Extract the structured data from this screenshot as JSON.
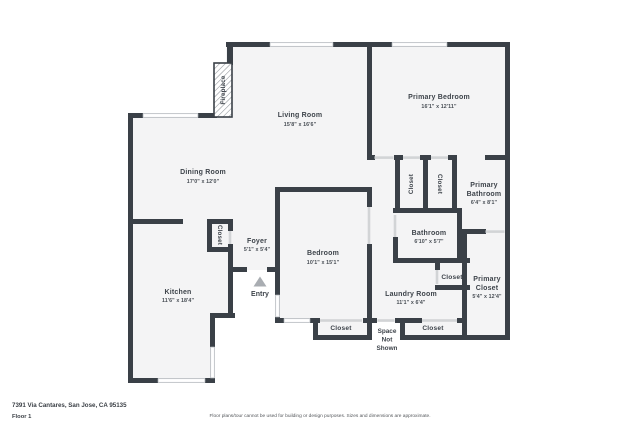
{
  "plan": {
    "rooms": {
      "living_room": {
        "name": "Living Room",
        "dims": "15'8\" x 16'6\""
      },
      "primary_bedroom": {
        "name": "Primary Bedroom",
        "dims": "16'1\" x 12'11\""
      },
      "dining_room": {
        "name": "Dining Room",
        "dims": "17'0\" x 12'0\""
      },
      "kitchen": {
        "name": "Kitchen",
        "dims": "11'6\" x 18'4\""
      },
      "foyer": {
        "name": "Foyer",
        "dims": "5'1\" x 5'4\""
      },
      "bedroom": {
        "name": "Bedroom",
        "dims": "10'1\" x 15'1\""
      },
      "bathroom": {
        "name": "Bathroom",
        "dims": "6'10\" x 5'7\""
      },
      "primary_bathroom": {
        "line1": "Primary",
        "line2": "Bathroom",
        "dims": "6'4\" x 8'1\""
      },
      "primary_closet": {
        "line1": "Primary",
        "line2": "Closet",
        "dims": "5'4\" x 12'4\""
      },
      "laundry_room": {
        "name": "Laundry Room",
        "dims": "11'1\" x 6'4\""
      }
    },
    "features": {
      "fireplace": "Fireplace",
      "entry": "Entry",
      "closet": "Closet",
      "space_not_shown": [
        "Space",
        "Not",
        "Shown"
      ]
    }
  },
  "footer": {
    "address": "7391 Via Cantares, San Jose, CA 95135",
    "floor": "Floor 1",
    "disclaimer": "Floor plans/tour cannot be used for building or design purposes. Sizes and dimensions are approximate."
  },
  "colors": {
    "wall": "#3a4047",
    "floor": "#f4f4f5",
    "accent_text": "#3e444b"
  }
}
